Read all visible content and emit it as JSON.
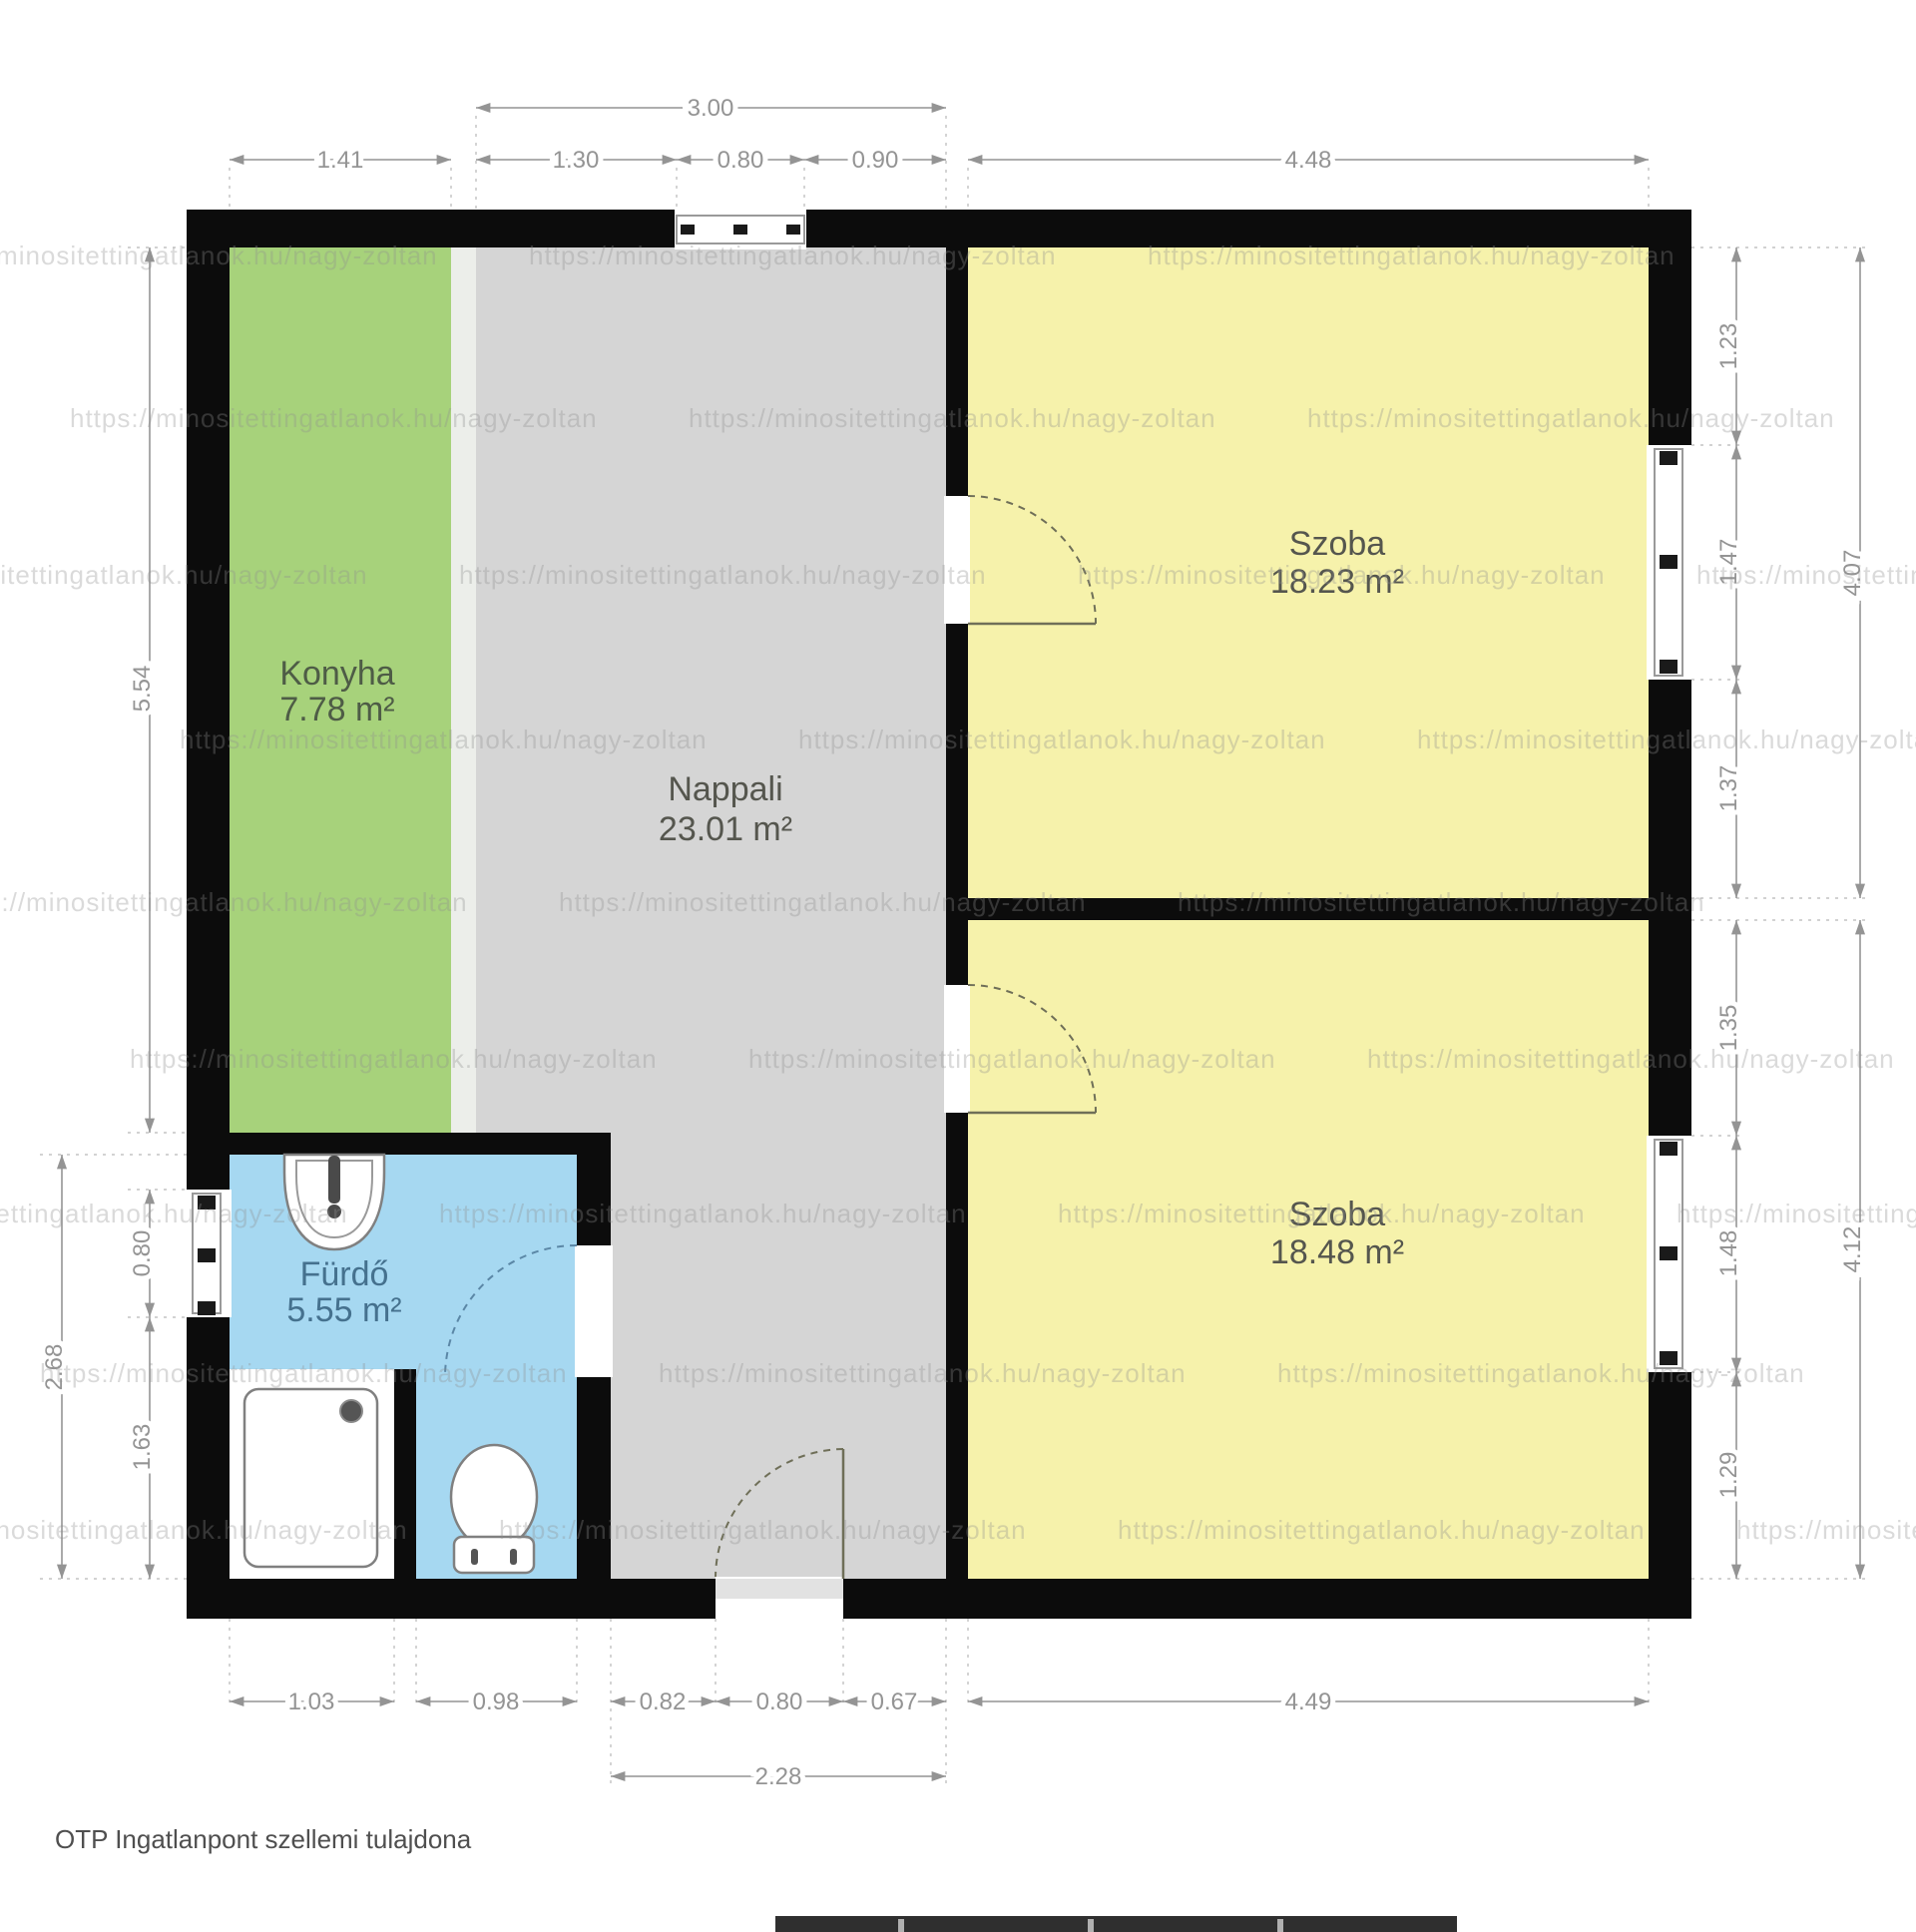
{
  "plan": {
    "rooms": {
      "kitchen": {
        "name": "Konyha",
        "area": "7.78 m²"
      },
      "living": {
        "name": "Nappali",
        "area": "23.01 m²"
      },
      "room1": {
        "name": "Szoba",
        "area": "18.23 m²"
      },
      "room2": {
        "name": "Szoba",
        "area": "18.48 m²"
      },
      "bath": {
        "name": "Fürdő",
        "area": "5.55 m²"
      }
    },
    "dims": {
      "top": {
        "overall": "3.00",
        "segs": [
          "1.41",
          "1.30",
          "0.80",
          "0.90"
        ],
        "room": "4.48"
      },
      "right": {
        "upper": {
          "segs": [
            "1.23",
            "1.47",
            "1.37"
          ],
          "overall": "4.07"
        },
        "lower": {
          "segs": [
            "1.35",
            "1.48",
            "1.29"
          ],
          "overall": "4.12"
        }
      },
      "left": {
        "kitchen": "5.54",
        "window": "0.80",
        "lower": "1.63",
        "overall": "2.68"
      },
      "bottom": {
        "segs": [
          "1.03",
          "0.98",
          "0.82",
          "0.80",
          "0.67"
        ],
        "room": "4.49",
        "overall": "2.28"
      }
    },
    "watermark": "https://minositettingatlanok.hu/nagy-zoltan",
    "footer": "OTP Ingatlanpont szellemi tulajdona",
    "colors": {
      "wall": "#0c0c0c",
      "kitchen": "#a7d27b",
      "living": "#d5d5d5",
      "room": "#f6f2ab",
      "bath": "#a6d8f1",
      "dim": "#949494",
      "label": "#55564e",
      "bath_label": "#45718e",
      "watermark_color": "#8f8f8f"
    }
  }
}
